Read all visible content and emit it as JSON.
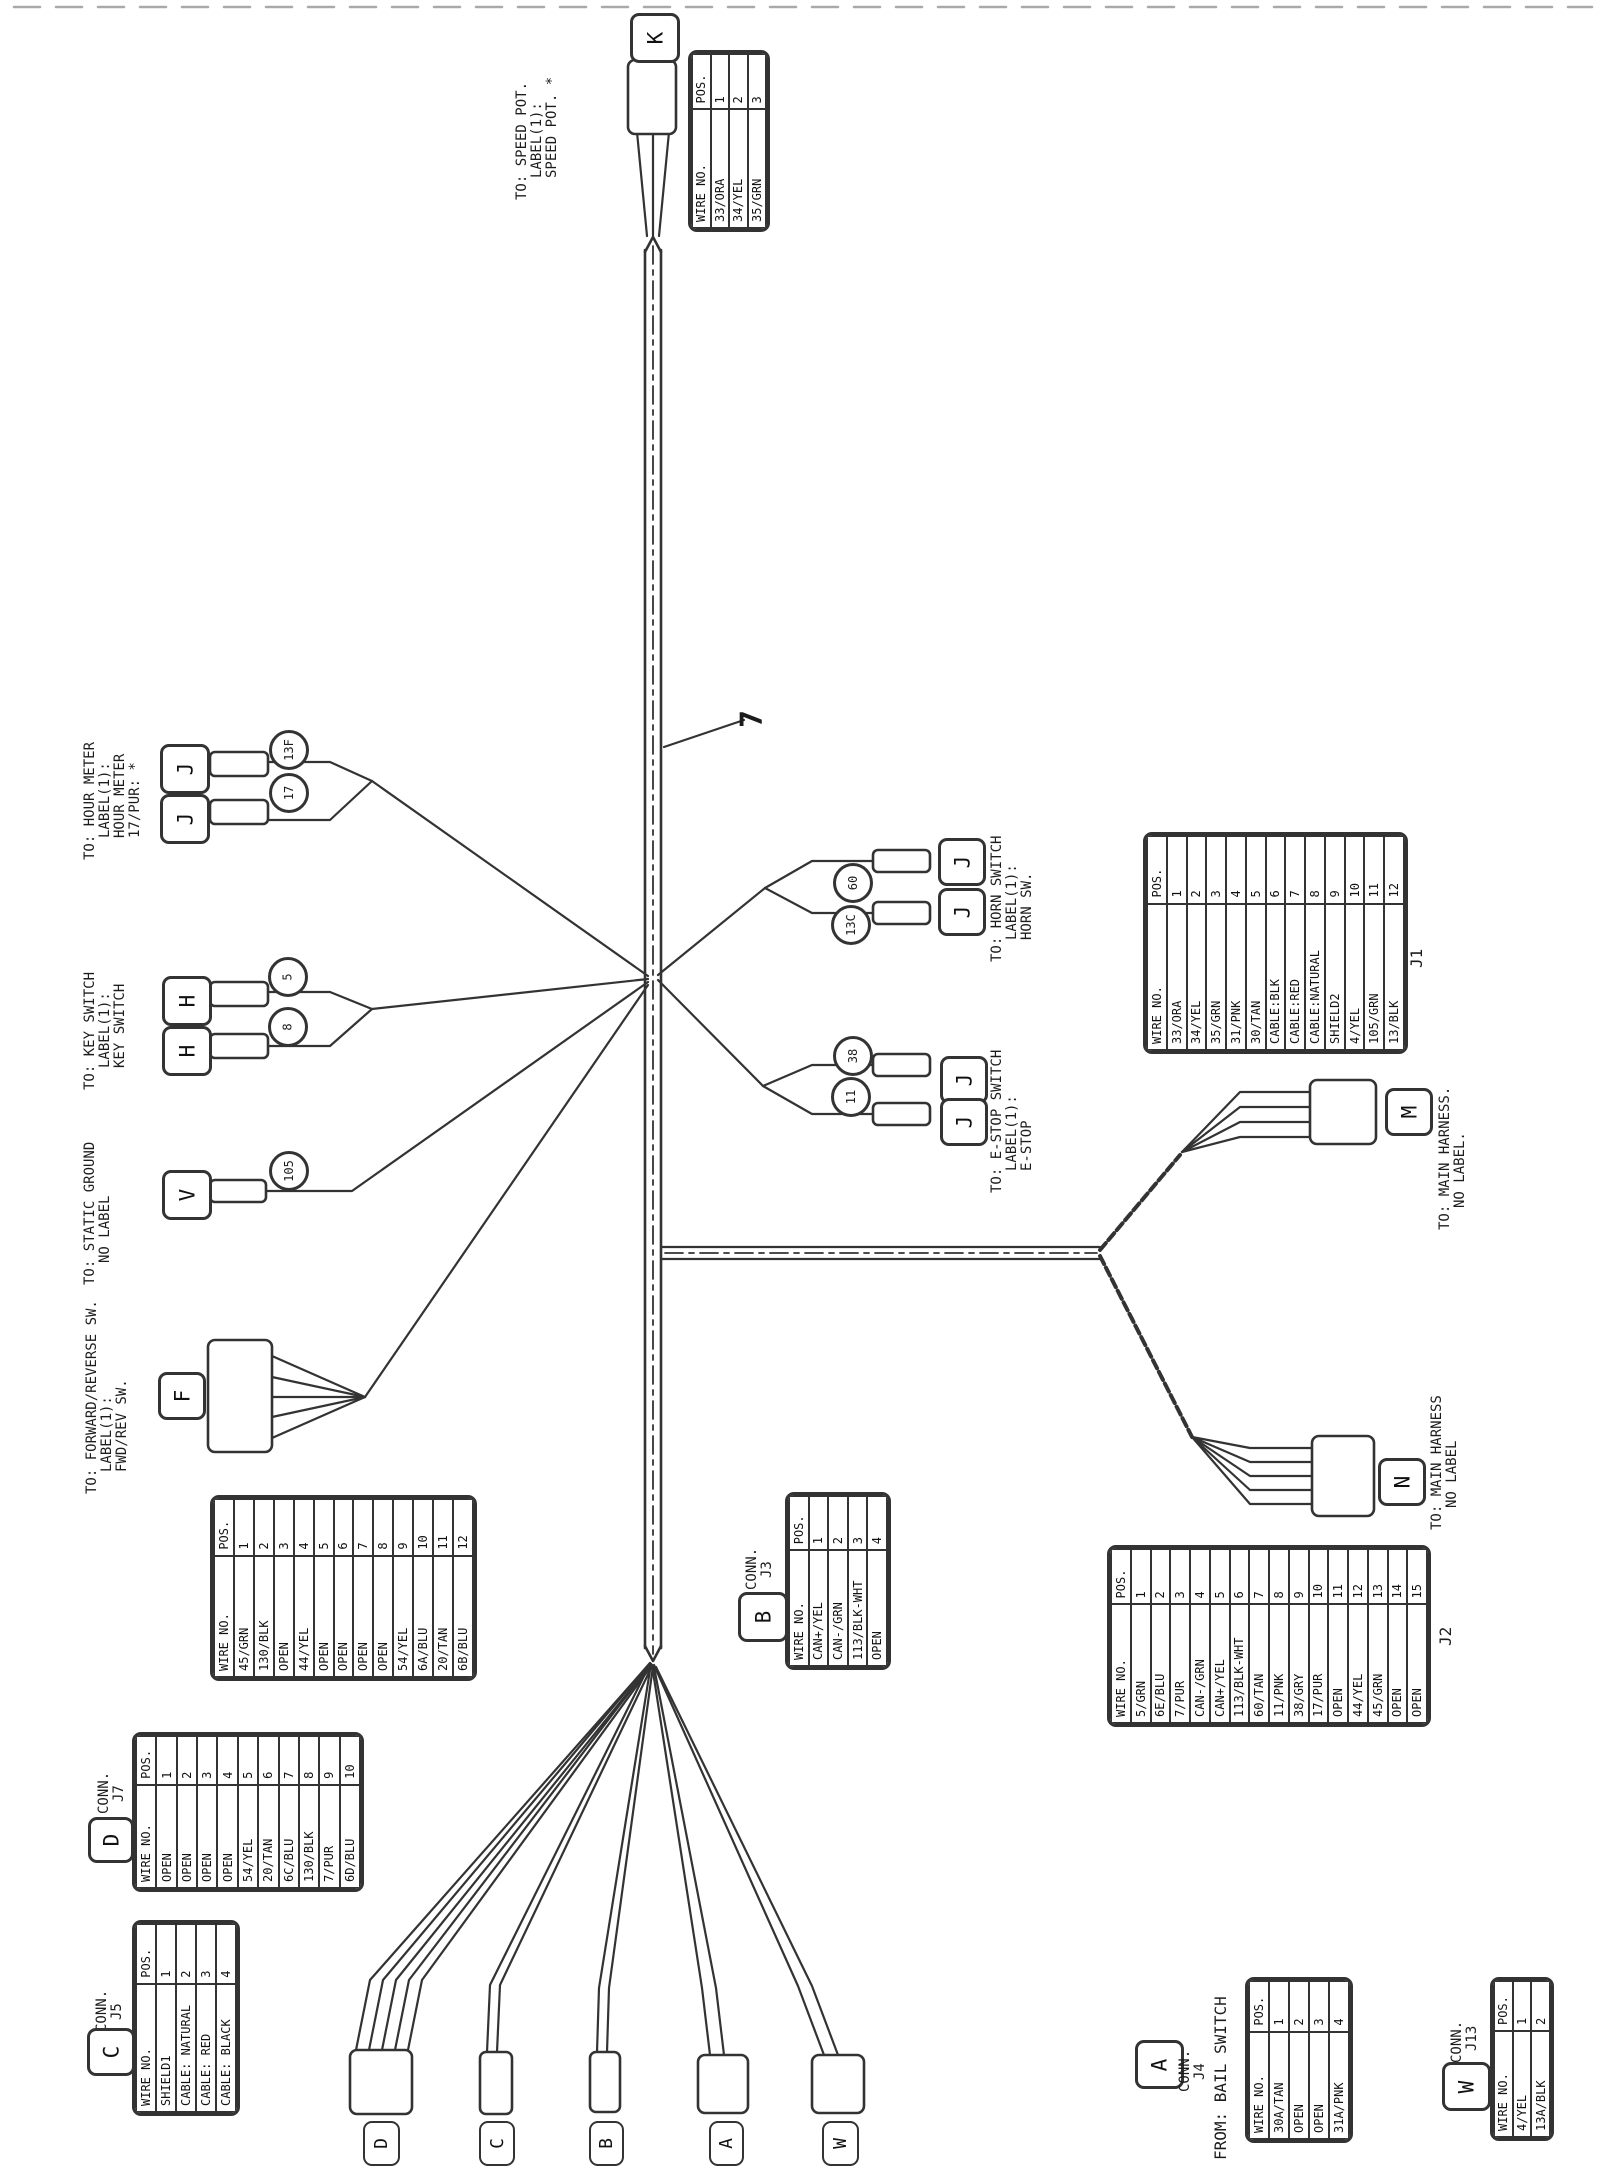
{
  "figure_number": "7",
  "bottom_connectors": [
    "D",
    "C",
    "B",
    "A",
    "W"
  ],
  "connector_letters": {
    "speed_pot": "K",
    "hour_meter": [
      "J",
      "J"
    ],
    "key_switch": [
      "H",
      "H"
    ],
    "static_ground": "V",
    "fwd_rev": "F",
    "horn": [
      "J",
      "J"
    ],
    "estop": [
      "J",
      "J"
    ],
    "main_m": "M",
    "main_n": "N",
    "j3": "B",
    "j7": "D",
    "j5": "C",
    "j4": "A",
    "j13": "W"
  },
  "rings": {
    "hour_meter": [
      "13F",
      "17"
    ],
    "key_switch": [
      "5",
      "8"
    ],
    "static_ground": [
      "105"
    ],
    "horn": [
      "60",
      "13C"
    ],
    "estop": [
      "38",
      "11"
    ]
  },
  "labels": {
    "speed_pot": [
      "TO: SPEED POT.",
      "LABEL(1):",
      "SPEED POT. *"
    ],
    "hour_meter": [
      "TO: HOUR METER",
      "LABEL(1):",
      "HOUR METER",
      "17/PUR: *"
    ],
    "key_switch": [
      "TO: KEY SWITCH",
      "LABEL(1):",
      "KEY SWITCH"
    ],
    "static_ground": [
      "TO: STATIC GROUND",
      "NO LABEL"
    ],
    "fwd_rev": [
      "TO: FORWARD/REVERSE SW.",
      "LABEL(1):",
      "FWD/REV SW."
    ],
    "horn": [
      "TO: HORN SWITCH",
      "LABEL(1):",
      "HORN SW."
    ],
    "estop": [
      "TO: E-STOP SWITCH",
      "LABEL(1):",
      "E-STOP"
    ],
    "main_m": [
      "TO: MAIN HARNESS.",
      "NO LABEL."
    ],
    "main_n": [
      "TO: MAIN HARNESS",
      "NO LABEL"
    ],
    "bail": "FROM: BAIL SWITCH",
    "conn_j3": [
      "CONN.",
      "J3"
    ],
    "conn_j7": [
      "CONN.",
      "J7"
    ],
    "conn_j5": [
      "CONN.",
      "J5"
    ],
    "conn_j4": [
      "CONN.",
      "J4"
    ],
    "conn_j13": [
      "CONN.",
      "J13"
    ],
    "j1": "J1",
    "j2": "J2"
  },
  "tables": {
    "k": {
      "headers": [
        "WIRE NO.",
        "POS."
      ],
      "rows": [
        [
          "33/ORA",
          "1"
        ],
        [
          "34/YEL",
          "2"
        ],
        [
          "35/GRN",
          "3"
        ]
      ]
    },
    "f": {
      "headers": [
        "WIRE NO.",
        "POS."
      ],
      "rows": [
        [
          "45/GRN",
          "1"
        ],
        [
          "130/BLK",
          "2"
        ],
        [
          "OPEN",
          "3"
        ],
        [
          "44/YEL",
          "4"
        ],
        [
          "OPEN",
          "5"
        ],
        [
          "OPEN",
          "6"
        ],
        [
          "OPEN",
          "7"
        ],
        [
          "OPEN",
          "8"
        ],
        [
          "54/YEL",
          "9"
        ],
        [
          "6A/BLU",
          "10"
        ],
        [
          "20/TAN",
          "11"
        ],
        [
          "6B/BLU",
          "12"
        ]
      ]
    },
    "j1": {
      "headers": [
        "WIRE NO.",
        "POS."
      ],
      "rows": [
        [
          "33/ORA",
          "1"
        ],
        [
          "34/YEL",
          "2"
        ],
        [
          "35/GRN",
          "3"
        ],
        [
          "31/PNK",
          "4"
        ],
        [
          "30/TAN",
          "5"
        ],
        [
          "CABLE:BLK",
          "6"
        ],
        [
          "CABLE:RED",
          "7"
        ],
        [
          "CABLE:NATURAL",
          "8"
        ],
        [
          "SHIELD2",
          "9"
        ],
        [
          "4/YEL",
          "10"
        ],
        [
          "105/GRN",
          "11"
        ],
        [
          "13/BLK",
          "12"
        ]
      ]
    },
    "j2": {
      "headers": [
        "WIRE NO.",
        "POS."
      ],
      "rows": [
        [
          "5/GRN",
          "1"
        ],
        [
          "6E/BLU",
          "2"
        ],
        [
          "7/PUR",
          "3"
        ],
        [
          "CAN-/GRN",
          "4"
        ],
        [
          "CAN+/YEL",
          "5"
        ],
        [
          "113/BLK-WHT",
          "6"
        ],
        [
          "60/TAN",
          "7"
        ],
        [
          "11/PNK",
          "8"
        ],
        [
          "38/GRY",
          "9"
        ],
        [
          "17/PUR",
          "10"
        ],
        [
          "OPEN",
          "11"
        ],
        [
          "44/YEL",
          "12"
        ],
        [
          "45/GRN",
          "13"
        ],
        [
          "OPEN",
          "14"
        ],
        [
          "OPEN",
          "15"
        ]
      ]
    },
    "j3": {
      "headers": [
        "WIRE NO.",
        "POS."
      ],
      "rows": [
        [
          "CAN+/YEL",
          "1"
        ],
        [
          "CAN-/GRN",
          "2"
        ],
        [
          "113/BLK-WHT",
          "3"
        ],
        [
          "OPEN",
          "4"
        ]
      ]
    },
    "j7": {
      "headers": [
        "WIRE NO.",
        "POS."
      ],
      "rows": [
        [
          "OPEN",
          "1"
        ],
        [
          "OPEN",
          "2"
        ],
        [
          "OPEN",
          "3"
        ],
        [
          "OPEN",
          "4"
        ],
        [
          "54/YEL",
          "5"
        ],
        [
          "20/TAN",
          "6"
        ],
        [
          "6C/BLU",
          "7"
        ],
        [
          "130/BLK",
          "8"
        ],
        [
          "7/PUR",
          "9"
        ],
        [
          "6D/BLU",
          "10"
        ]
      ]
    },
    "j5": {
      "headers": [
        "WIRE NO.",
        "POS."
      ],
      "rows": [
        [
          "SHIELD1",
          "1"
        ],
        [
          "CABLE: NATURAL",
          "2"
        ],
        [
          "CABLE: RED",
          "3"
        ],
        [
          "CABLE: BLACK",
          "4"
        ]
      ]
    },
    "j4": {
      "headers": [
        "WIRE NO.",
        "POS."
      ],
      "rows": [
        [
          "30A/TAN",
          "1"
        ],
        [
          "OPEN",
          "2"
        ],
        [
          "OPEN",
          "3"
        ],
        [
          "31A/PNK",
          "4"
        ]
      ]
    },
    "j13": {
      "headers": [
        "WIRE NO.",
        "POS."
      ],
      "rows": [
        [
          "4/YEL",
          "1"
        ],
        [
          "13A/BLK",
          "2"
        ]
      ]
    }
  },
  "colors": {
    "line": "#333333",
    "background": "#ffffff"
  }
}
